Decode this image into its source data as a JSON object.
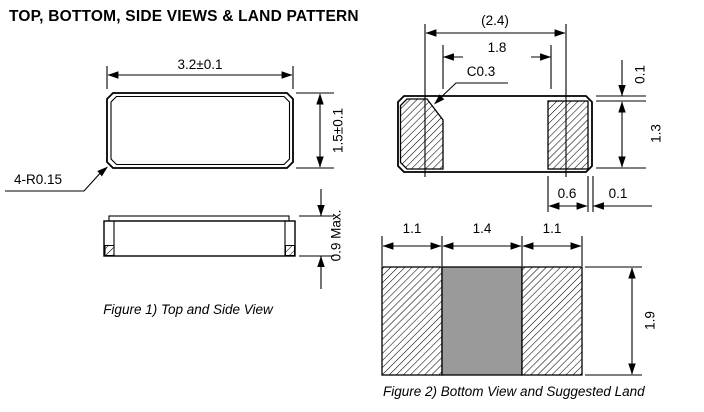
{
  "title": "TOP, BOTTOM, SIDE VIEWS & LAND PATTERN",
  "colors": {
    "line": "#000000",
    "background": "#ffffff",
    "land_center_gray": "#9a9a9a"
  },
  "figure1": {
    "caption": "Figure 1) Top and  Side View",
    "top_view": {
      "width_dim": "3.2±0.1",
      "height_dim": "1.5±0.1",
      "corner_label": "4-R0.15"
    },
    "side_view": {
      "max_height_dim": "0.9 Max."
    }
  },
  "figure2": {
    "caption": "Figure 2) Bottom View  and Suggested  Land",
    "bottom_view": {
      "electrode_span_dim": "(2.4)",
      "electrode_gap_dim": "1.8",
      "chamfer_label": "C0.3",
      "pad_top_inset_dim": "0.1",
      "pad_height_dim": "1.3",
      "pad_width_dim": "0.6",
      "pad_side_inset_dim": "0.1"
    },
    "land_pattern": {
      "left_pad_width_dim": "1.1",
      "center_width_dim": "1.4",
      "right_pad_width_dim": "1.1",
      "height_dim": "1.9"
    }
  }
}
